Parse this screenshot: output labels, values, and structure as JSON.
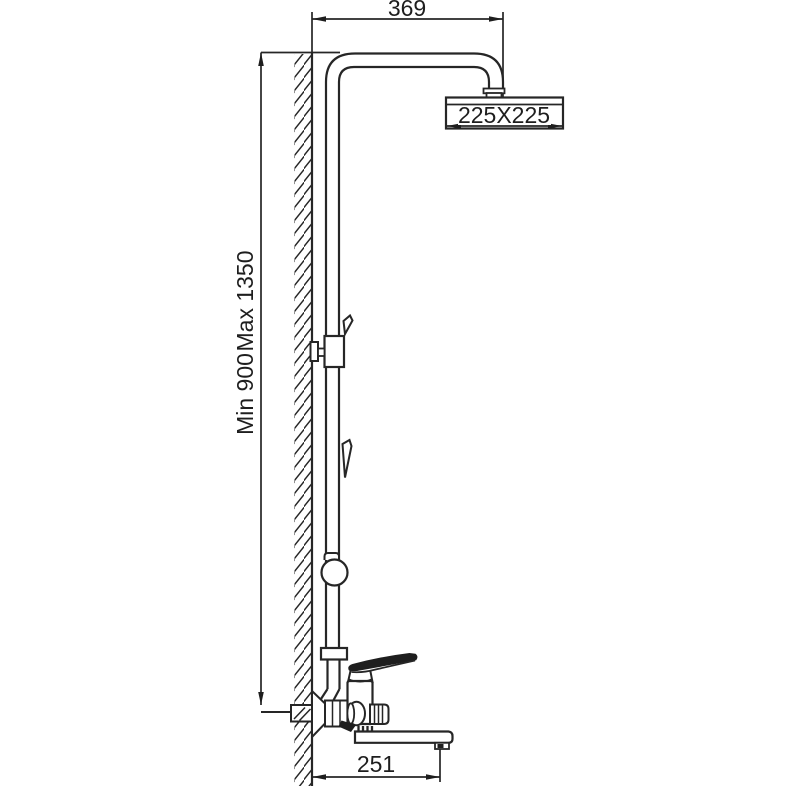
{
  "page": {
    "background": "#ffffff"
  },
  "diagram": {
    "type": "technical-drawing",
    "stroke_color": "#262626",
    "text_color": "#1e1e1e",
    "labels": {
      "arm_width": "369",
      "head_size": "225X225",
      "height_min": "Min 900",
      "height_max": "Max 1350",
      "spout_length": "251"
    }
  }
}
